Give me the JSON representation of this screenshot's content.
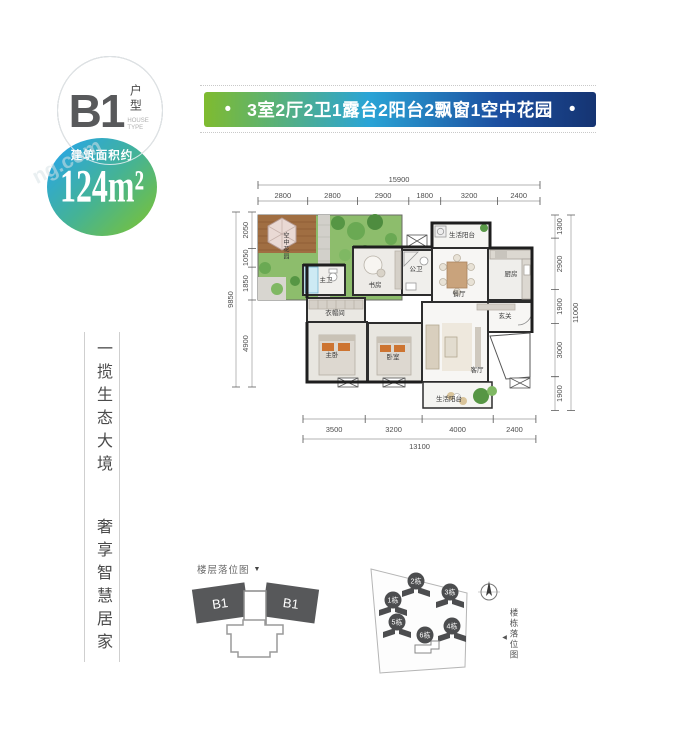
{
  "type_badge": {
    "code": "B1",
    "label_cn": "户型",
    "label_en": "HOUSE TYPE"
  },
  "area_badge": {
    "prefix": "建筑面积约",
    "value": "124m²",
    "gradient": [
      "#2ba7de",
      "#76c13d"
    ]
  },
  "feature_banner": {
    "bullet": "•",
    "text": "3室2厅2卫1露台2阳台2飘窗1空中花园",
    "gradient": [
      "#7fbb2f",
      "#2aa4d6",
      "#1c4fa0",
      "#153472"
    ]
  },
  "tagline": {
    "line1": "一揽生态大境",
    "line2": "奢享智慧居家"
  },
  "watermark": "ng.com",
  "floor_plan": {
    "room_labels": [
      "空中花园",
      "主卫",
      "书房",
      "公卫",
      "生活阳台",
      "餐厅",
      "厨房",
      "玄关",
      "衣帽间",
      "主卧",
      "卧室",
      "客厅",
      "生活阳台"
    ],
    "wall_color": "#2d2d2d",
    "dimensions": {
      "top": {
        "total": "15900",
        "segments": [
          "2800",
          "2800",
          "2900",
          "1800",
          "3200",
          "2400"
        ]
      },
      "left": {
        "total": "9850",
        "segments": [
          "2050",
          "1050",
          "1850",
          "4900"
        ]
      },
      "right": {
        "total": "11000",
        "segments": [
          "1300",
          "2900",
          "1900",
          "3000",
          "1900"
        ]
      },
      "bottom": {
        "total": "13100",
        "segments": [
          "3500",
          "3200",
          "4000",
          "2400"
        ]
      }
    }
  },
  "floor_position": {
    "title": "楼层落位图",
    "marker": "▼",
    "unit_labels": [
      "B1",
      "B1"
    ],
    "building_fill": "#57585a"
  },
  "site_position": {
    "title": "楼栋落位图",
    "marker": "◀",
    "buildings": [
      "1栋",
      "2栋",
      "3栋",
      "4栋",
      "5栋",
      "6栋"
    ]
  }
}
